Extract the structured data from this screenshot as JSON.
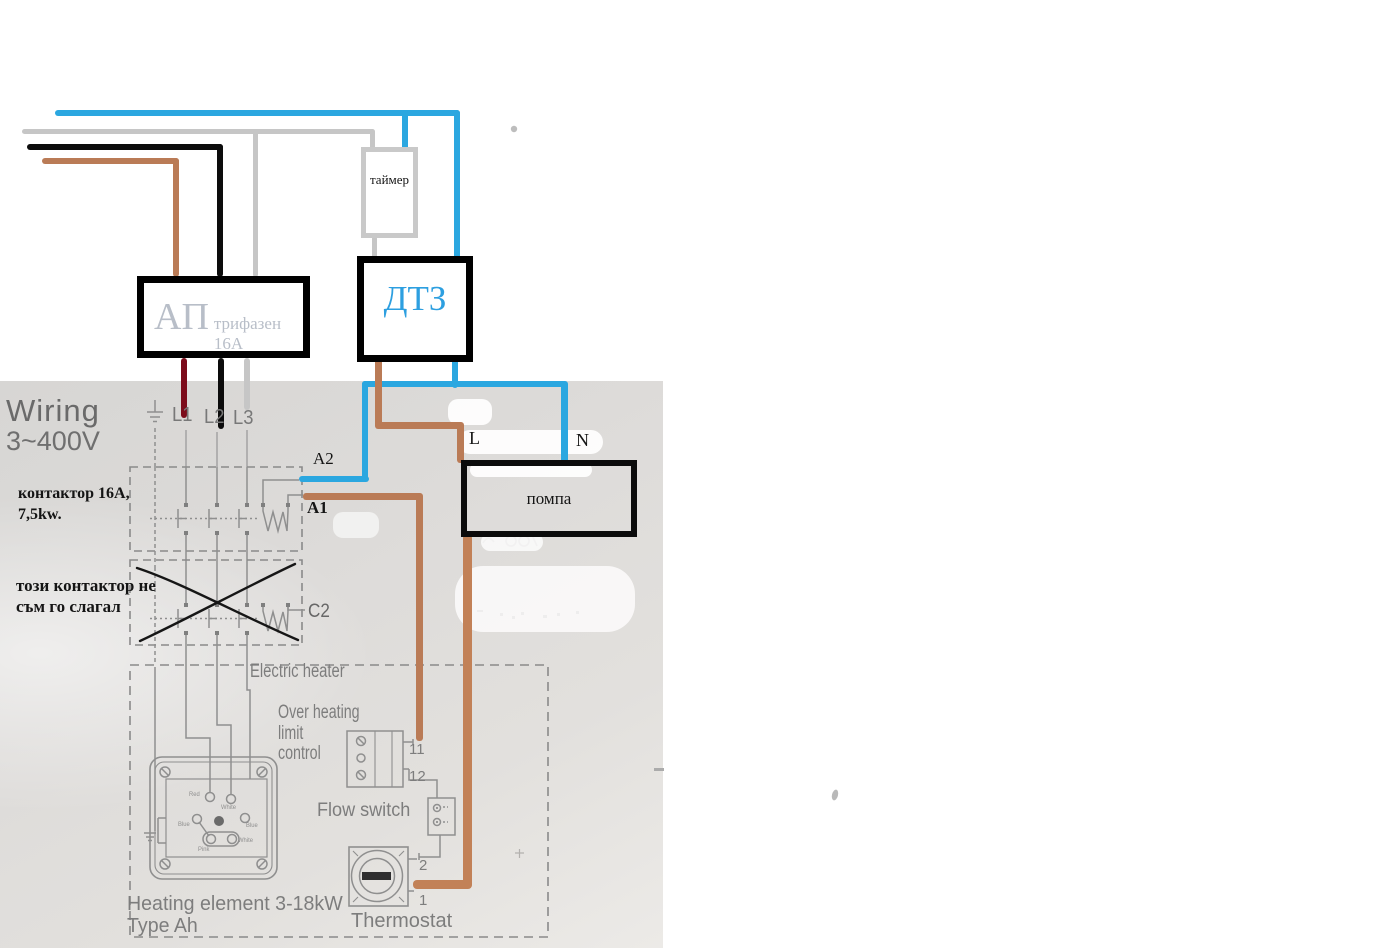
{
  "annotations": {
    "timer_label": "таймер",
    "dtz_label": "ДТЗ",
    "ap_label": "АП",
    "ap_sub_label": "трифазен 16А",
    "pump_label": "помпа",
    "contactor_note": "контактор 16А,\n7,5kw.",
    "crossed_note": "този контактор не\nсъм го слагал",
    "a2_label": "A2",
    "a1_label": "A1",
    "l_label": "L",
    "n_label": "N"
  },
  "printed_diagram": {
    "title": "Wiring",
    "voltage": "3~400V",
    "phase_labels": [
      "L1",
      "L2",
      "L3"
    ],
    "c2_label": "C2",
    "electric_heater": "Electric heater",
    "over_heating": "Over heating\nlimit\ncontrol",
    "terminal_11": "11",
    "terminal_12": "12",
    "flow_switch": "Flow switch",
    "terminal_2": "2",
    "terminal_1": "1",
    "heating_element": "Heating element 3-18kW\nType Ah",
    "thermostat": "Thermostat",
    "element_pins": [
      "Red",
      "White",
      "Blue",
      "Blue",
      "Pink",
      "White"
    ]
  },
  "colors": {
    "wire_blue": "#2ba7e0",
    "wire_gray": "#c6c6c6",
    "wire_black": "#0c0c0c",
    "wire_brown": "#ba7b56",
    "wire_brown_thick": "#c28157",
    "wire_dark_red": "#7c0c1b",
    "dtz_text": "#2d9fe0",
    "ap_text": "#b8bec8",
    "printed_gray": "#7d7d7d"
  }
}
